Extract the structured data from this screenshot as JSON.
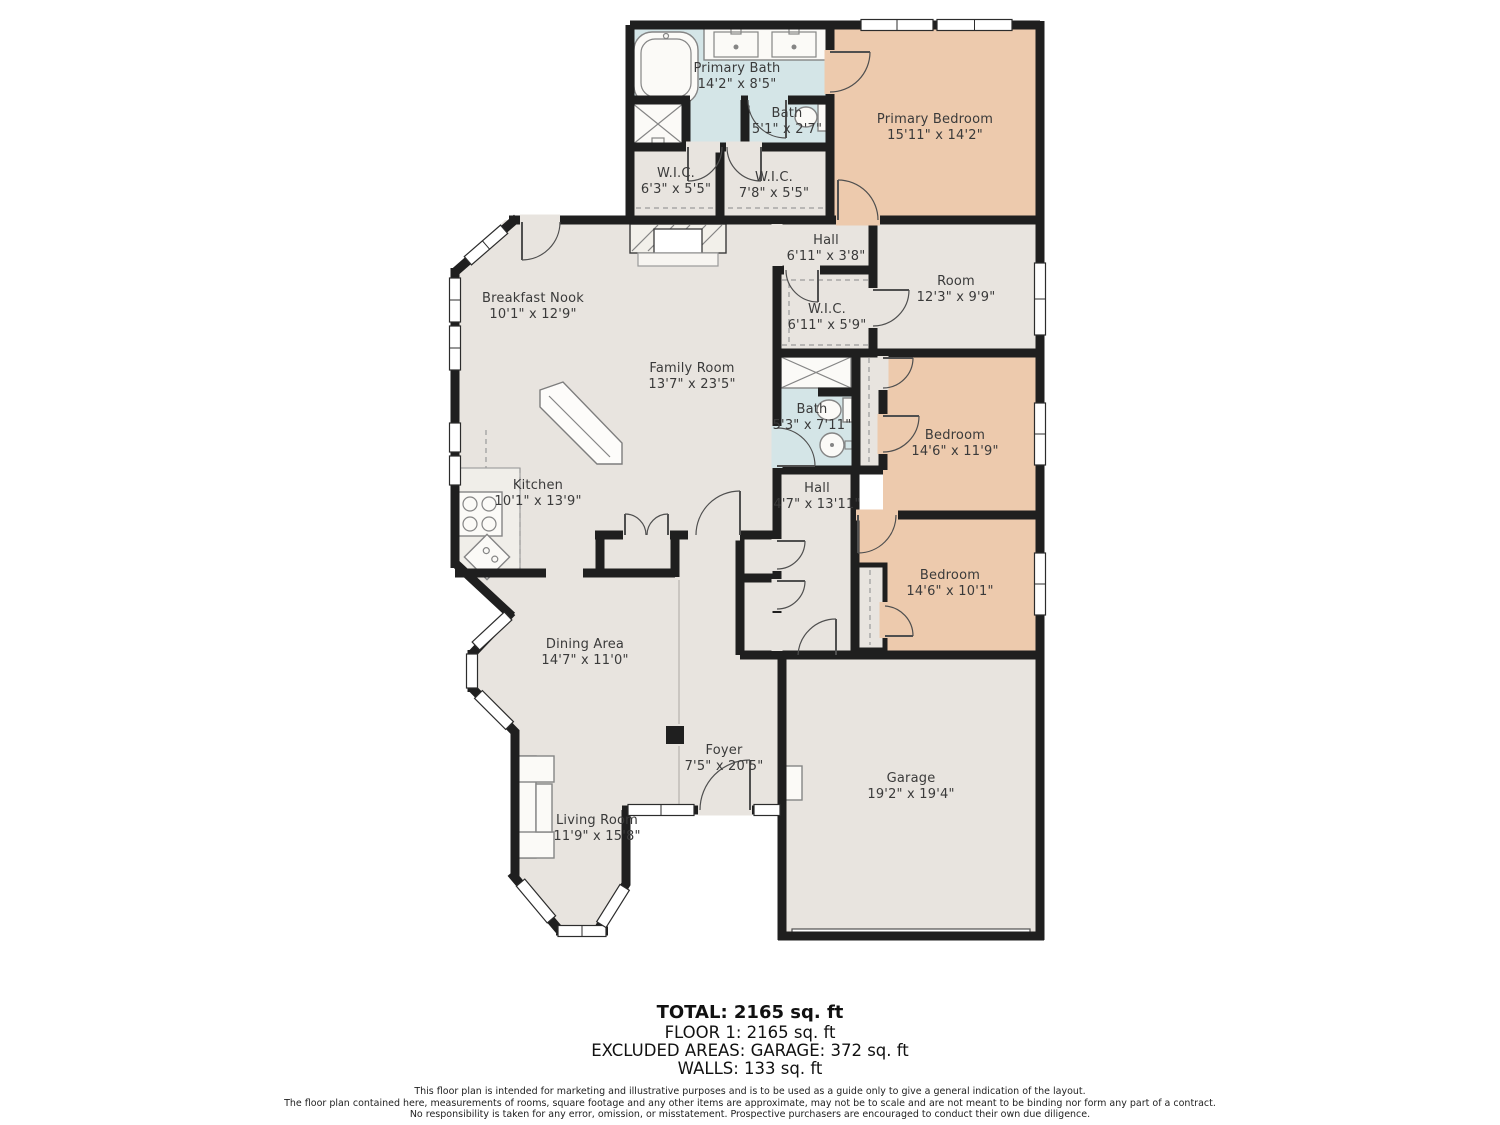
{
  "title": "Floor plan",
  "colors": {
    "wall": "#1f1f1f",
    "room_default": "#e8e4df",
    "bedroom": "#edcaad",
    "bathroom": "#d4e5e7",
    "background": "#ffffff",
    "label_text": "#3a3a3a"
  },
  "rooms": [
    {
      "id": "primary-bath",
      "name": "Primary Bath",
      "dims": "14'2\" x 8'5\""
    },
    {
      "id": "bath-small",
      "name": "Bath",
      "dims": "5'1\" x 2'7\""
    },
    {
      "id": "primary-bedroom",
      "name": "Primary Bedroom",
      "dims": "15'11\" x 14'2\""
    },
    {
      "id": "wic-1",
      "name": "W.I.C.",
      "dims": "6'3\" x 5'5\""
    },
    {
      "id": "wic-2",
      "name": "W.I.C.",
      "dims": "7'8\" x 5'5\""
    },
    {
      "id": "hall-upper",
      "name": "Hall",
      "dims": "6'11\" x 3'8\""
    },
    {
      "id": "room",
      "name": "Room",
      "dims": "12'3\" x 9'9\""
    },
    {
      "id": "wic-3",
      "name": "W.I.C.",
      "dims": "6'11\" x 5'9\""
    },
    {
      "id": "breakfast-nook",
      "name": "Breakfast Nook",
      "dims": "10'1\" x 12'9\""
    },
    {
      "id": "family-room",
      "name": "Family Room",
      "dims": "13'7\" x 23'5\""
    },
    {
      "id": "bath-2",
      "name": "Bath",
      "dims": "5'3\" x 7'11\""
    },
    {
      "id": "bedroom-1",
      "name": "Bedroom",
      "dims": "14'6\" x 11'9\""
    },
    {
      "id": "kitchen",
      "name": "Kitchen",
      "dims": "10'1\" x 13'9\""
    },
    {
      "id": "hall-lower",
      "name": "Hall",
      "dims": "4'7\" x 13'11\""
    },
    {
      "id": "bedroom-2",
      "name": "Bedroom",
      "dims": "14'6\" x 10'1\""
    },
    {
      "id": "dining-area",
      "name": "Dining Area",
      "dims": "14'7\" x 11'0\""
    },
    {
      "id": "foyer",
      "name": "Foyer",
      "dims": "7'5\" x 20'5\""
    },
    {
      "id": "living-room",
      "name": "Living Room",
      "dims": "11'9\" x 15'8\""
    },
    {
      "id": "garage",
      "name": "Garage",
      "dims": "19'2\" x 19'4\""
    }
  ],
  "summary": {
    "total": "TOTAL: 2165 sq. ft",
    "floor1": "FLOOR 1: 2165 sq. ft",
    "excluded": "EXCLUDED AREAS: GARAGE: 372 sq. ft",
    "walls": "WALLS: 133 sq. ft"
  },
  "disclaimer": {
    "line1": "This floor plan is intended for marketing and illustrative purposes and is to be used as a guide only to give a general indication of the layout.",
    "line2": "The floor plan contained here, measurements of rooms, square footage and any other items are approximate, may not be to scale and are not meant to be binding nor form any part of a contract.",
    "line3": "No responsibility is taken for any error, omission, or misstatement. Prospective purchasers are encouraged to conduct their own due diligence."
  }
}
